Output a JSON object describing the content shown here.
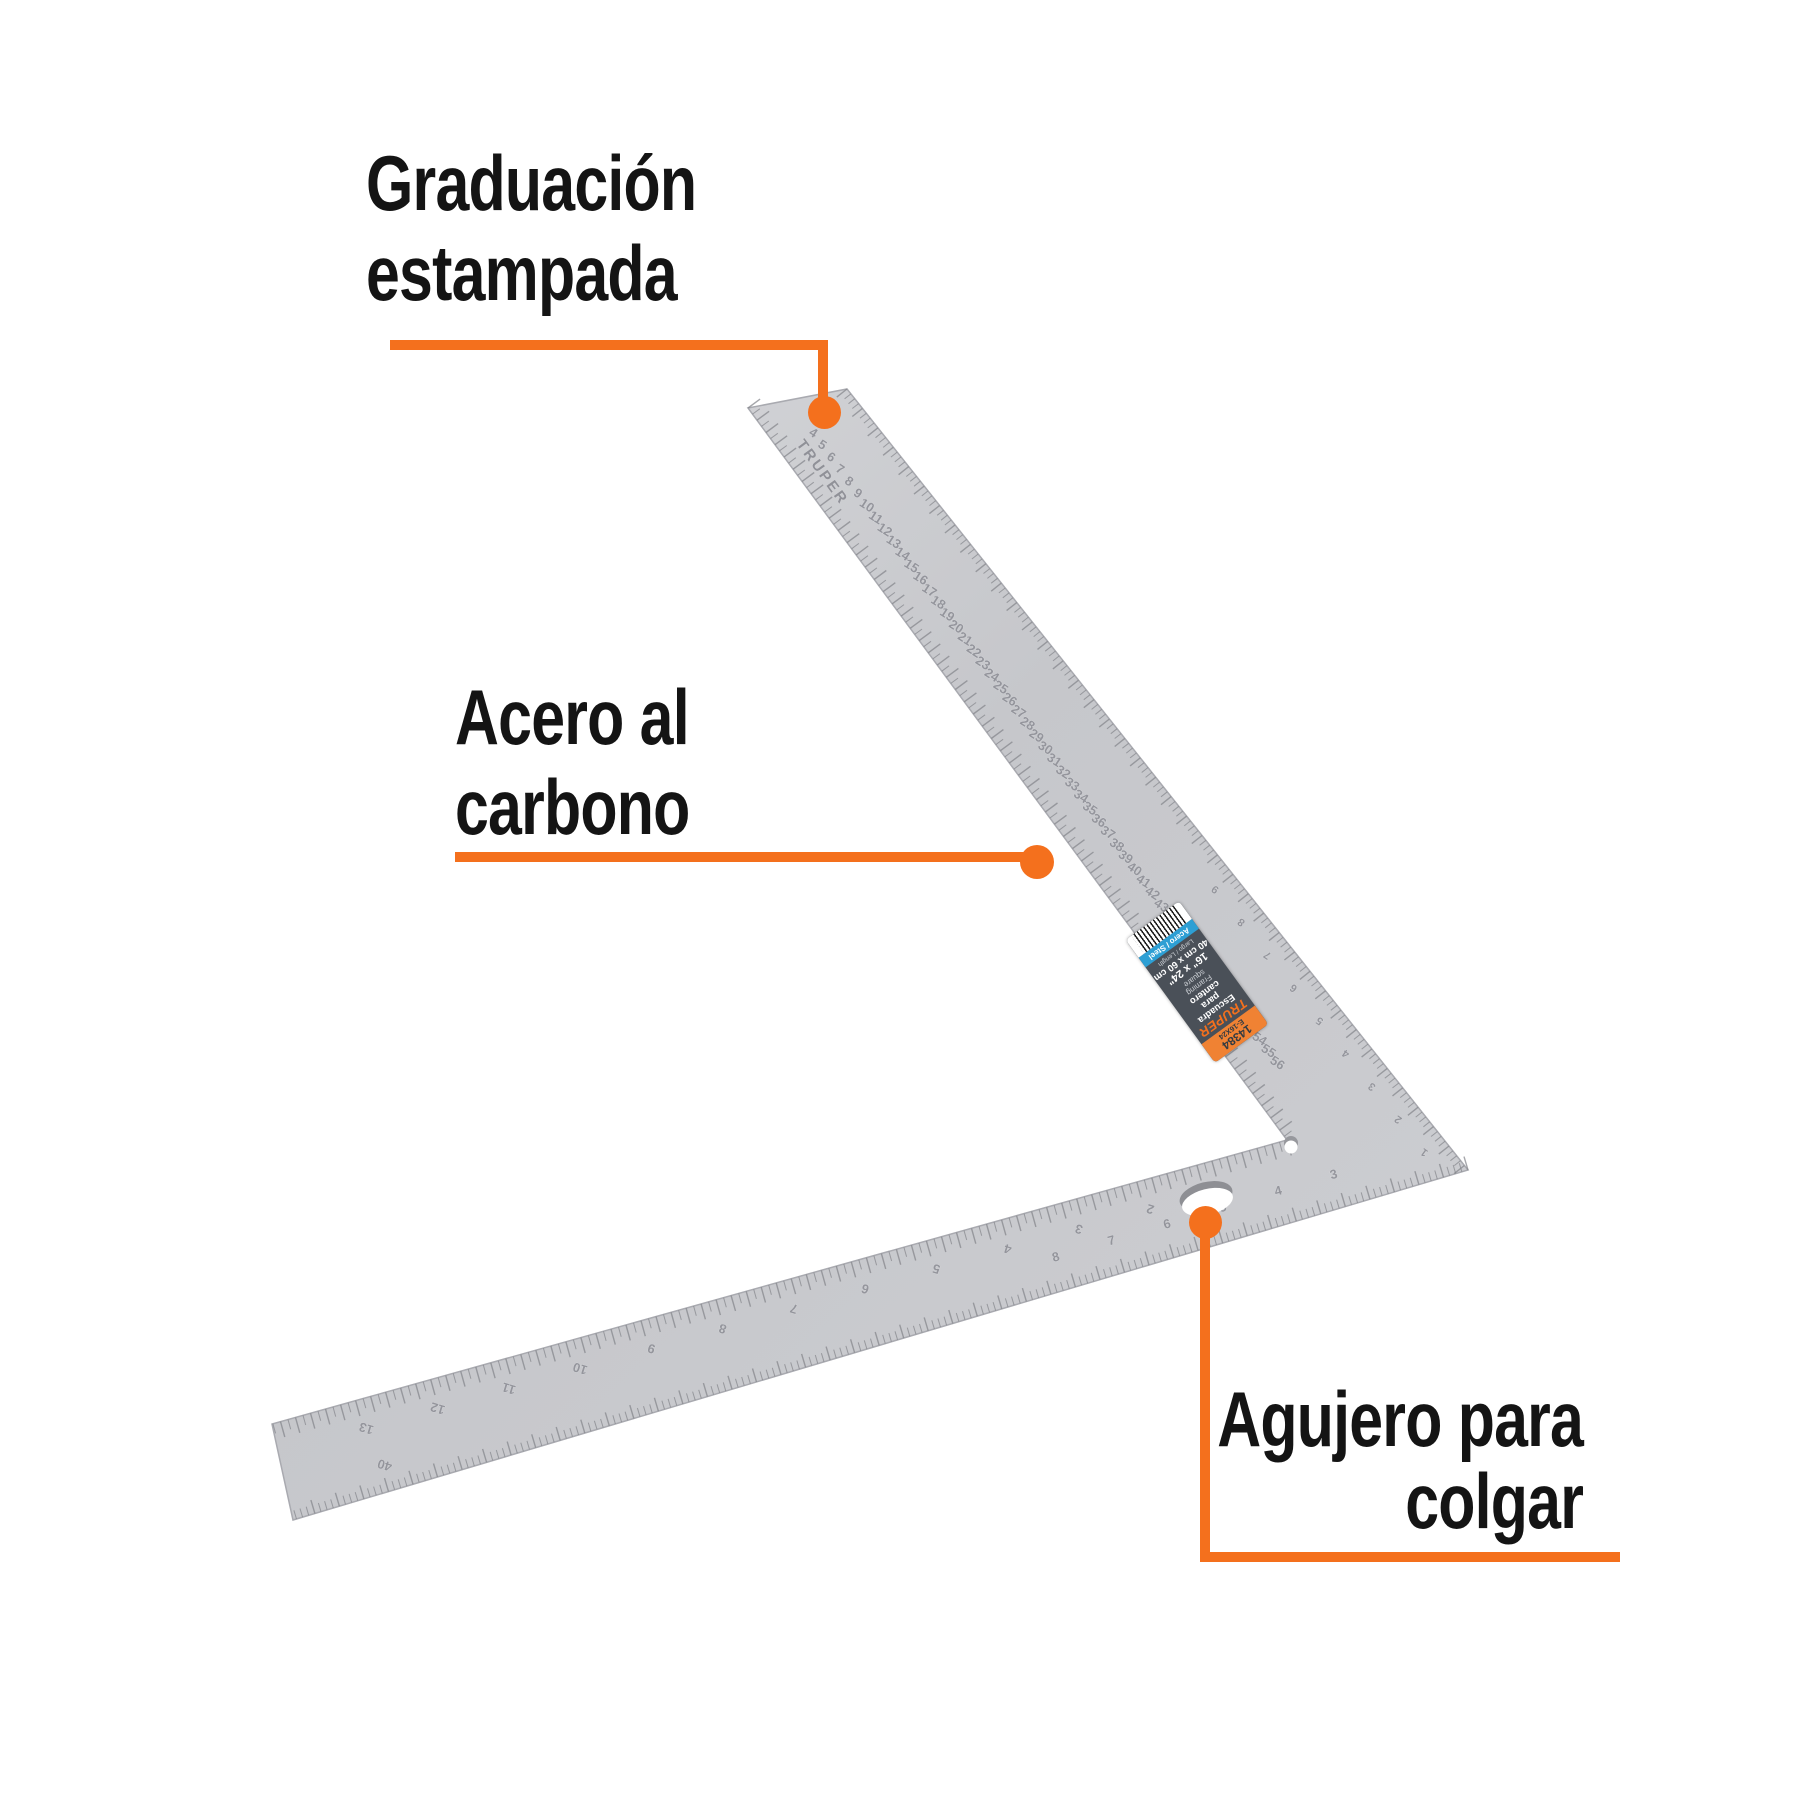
{
  "accent_color": "#F4701D",
  "callouts": [
    {
      "id": "graduacion",
      "lines": [
        "Graduación",
        "estampada"
      ]
    },
    {
      "id": "acero",
      "lines": [
        "Acero al",
        "carbono"
      ]
    },
    {
      "id": "agujero",
      "lines": [
        "Agujero para",
        "colgar"
      ]
    }
  ],
  "square": {
    "brand_stamp": "TRUPER",
    "blade_cm_numbers": [
      "4",
      "5",
      "6",
      "7",
      "8",
      "9",
      "10",
      "11",
      "12",
      "13",
      "14",
      "15",
      "16",
      "17",
      "18",
      "19",
      "20",
      "21",
      "22",
      "23",
      "24",
      "25",
      "26",
      "27",
      "28",
      "29",
      "30",
      "31",
      "32",
      "33",
      "34",
      "35",
      "36",
      "37",
      "38",
      "39",
      "40",
      "41",
      "42",
      "43",
      "52",
      "53",
      "54",
      "55",
      "56"
    ],
    "blade_inch_numbers": [
      "1",
      "2",
      "3",
      "4",
      "5",
      "6",
      "7",
      "8",
      "9"
    ],
    "arm_top_numbers": [
      "1",
      "2",
      "3",
      "4",
      "5",
      "6",
      "7",
      "8",
      "9",
      "10",
      "11",
      "12",
      "13"
    ],
    "arm_lower_numbers": [
      "3",
      "4",
      "5",
      "6",
      "7",
      "8"
    ],
    "arm_end_number": "40",
    "steel_color": "#c7c8cc",
    "tick_color": "#84858b"
  },
  "sticker": {
    "code": "14384",
    "model": "E-16X24",
    "brand": "TRUPER",
    "name_lines": [
      "Escuadra",
      "para",
      "cantero"
    ],
    "name_en_lines": [
      "Framing",
      "square"
    ],
    "size_in": "16\" x 24\"",
    "size_cm": "40 cm x 60 cm",
    "length_label": "Largo / Length",
    "material_label": "Acero / Steel",
    "colors": {
      "orange": "#F08233",
      "dark": "#4a5058",
      "blue": "#2d9fd4",
      "logo": "#F4701D"
    }
  }
}
